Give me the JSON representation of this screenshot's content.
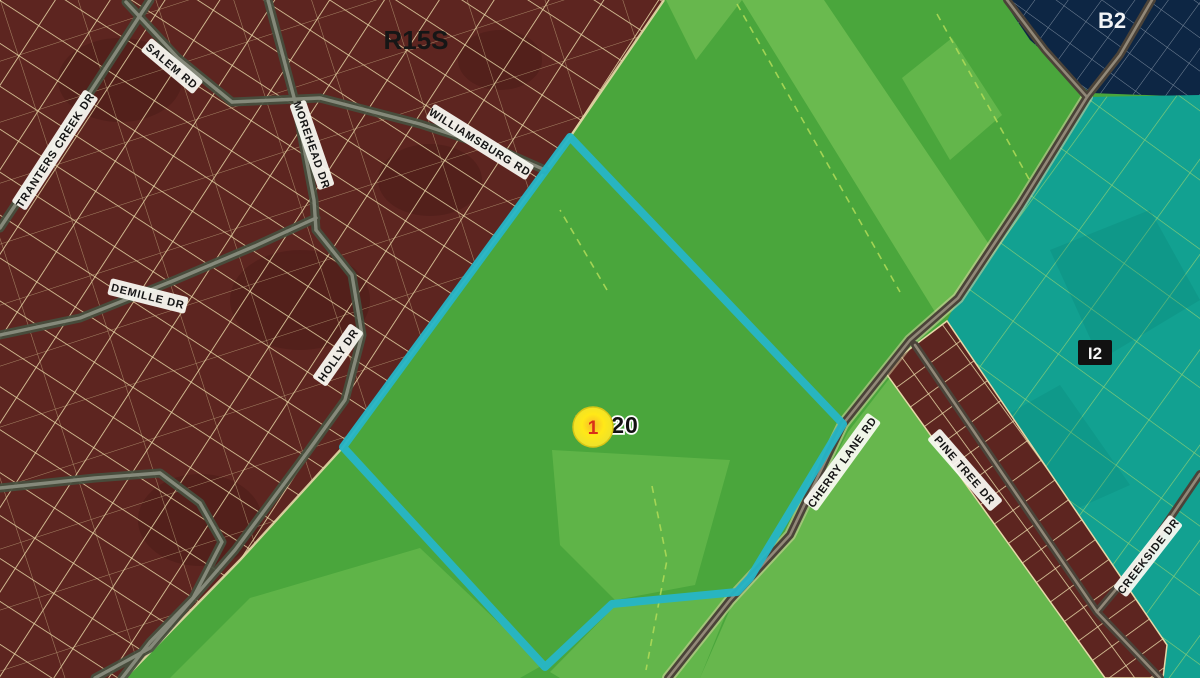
{
  "map": {
    "title": "zoning-parcel-map",
    "zone_labels": {
      "r15s": "R15S",
      "b2": "B2",
      "i2": "I2"
    },
    "marker": {
      "parcel_text": "RA20",
      "number": "1"
    },
    "road_labels": {
      "tranters": "TRANTERS CREEK DR",
      "salem": "SALEM RD",
      "morehead": "MOREHEAD DR",
      "williamsburg": "WILLIAMSBURG RD",
      "demille": "DEMILLE DR",
      "holly": "HOLLY DR",
      "cherry": "CHERRY LANE RD",
      "pinetree": "PINE TREE DR",
      "creekside": "CREEKSIDE DR"
    },
    "colors": {
      "residential_maroon": "#5d2520",
      "field_green": "#4aa63c",
      "field_green_light": "#93d366",
      "industrial_teal": "#12a191",
      "business_navy": "#0d2644",
      "highlight_boundary": "#27b5c6",
      "parcel_line_cream": "#ead9a8",
      "road_gray": "#47503f",
      "marker_yellow": "#ffe818",
      "marker_number_red": "#d93018"
    }
  }
}
